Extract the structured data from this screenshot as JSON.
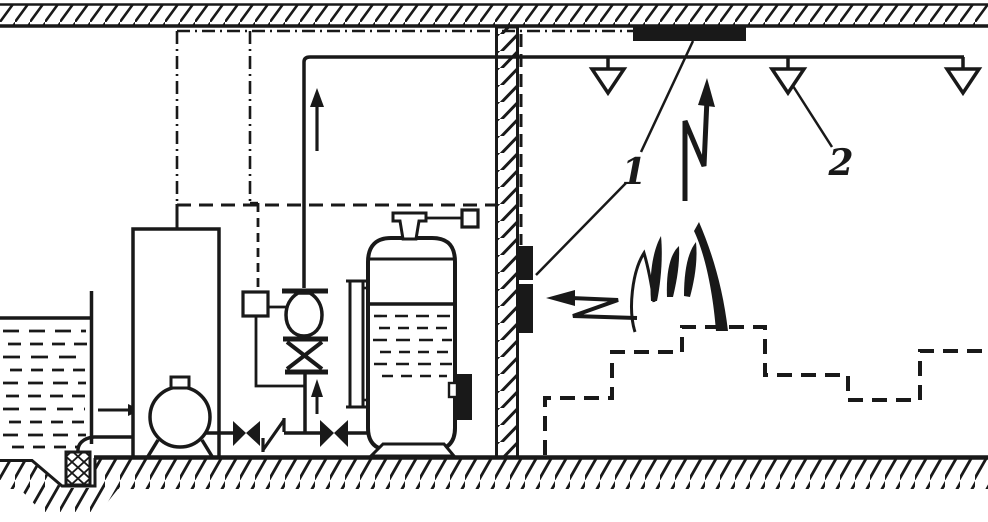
{
  "diagram": {
    "callouts": {
      "detectors_label": "1",
      "sprinklers_label": "2"
    },
    "colors": {
      "ink": "#191919",
      "paper": "#ffffff"
    }
  }
}
